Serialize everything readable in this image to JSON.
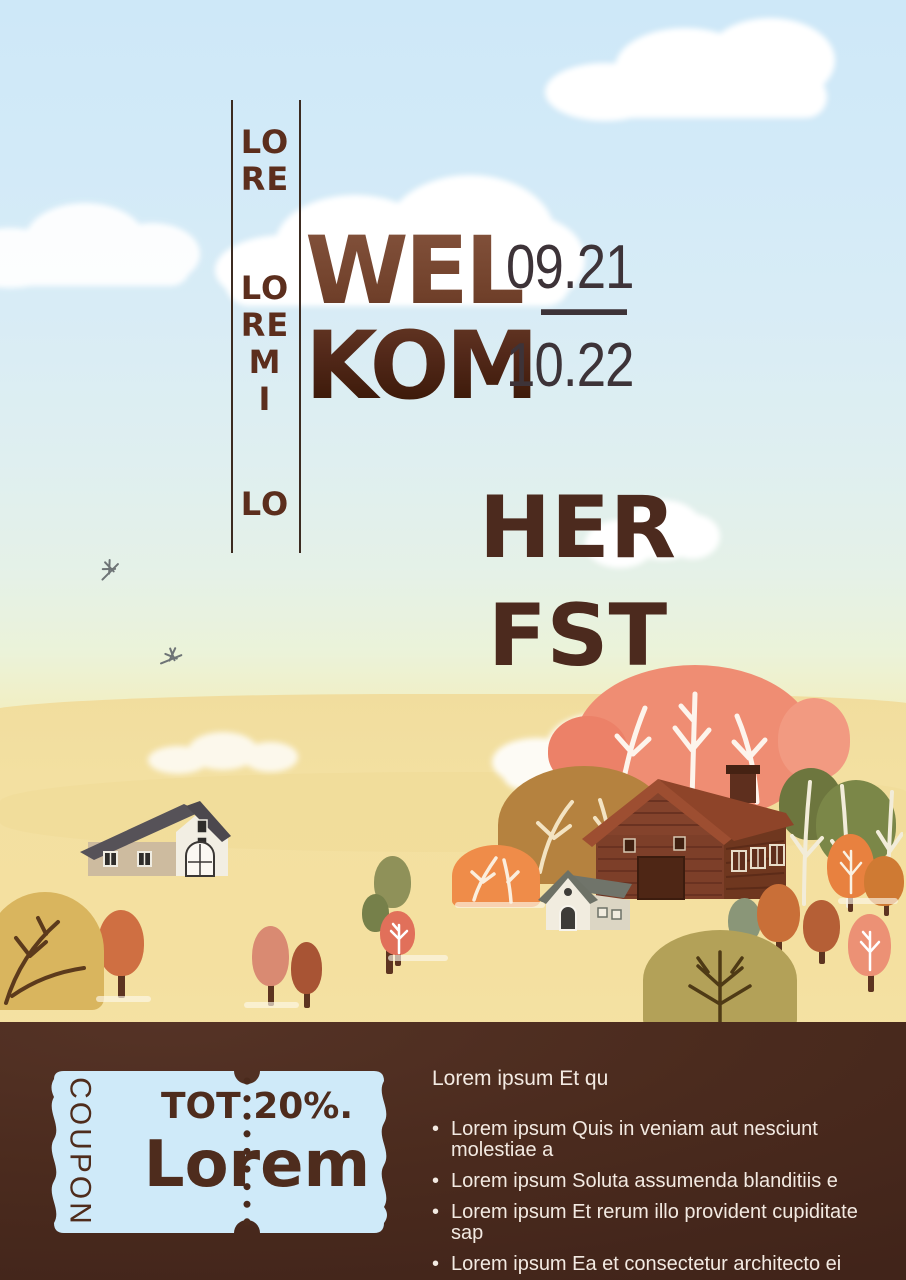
{
  "poster": {
    "vertical_banner": {
      "group1": [
        "LO",
        "RE"
      ],
      "group2": [
        "LO",
        "RE",
        "M",
        "I"
      ],
      "group3": [
        "LO"
      ]
    },
    "title": {
      "line1": "WEL",
      "line2": "KOM"
    },
    "dates": {
      "start": "09.21",
      "separator": "—",
      "end": "10.22"
    },
    "season": {
      "line1": "HER",
      "line2": "FST"
    }
  },
  "footer": {
    "coupon": {
      "stub_label": "COUPON",
      "discount": "TOT 20%.",
      "brand": "Lorem"
    },
    "info": {
      "heading": "Lorem ipsum Et qu",
      "bullets": [
        "Lorem ipsum Quis in veniam aut nesciunt molestiae a",
        "Lorem ipsum Soluta assumenda blanditiis e",
        "Lorem ipsum Et rerum illo provident cupiditate sap",
        "Lorem ipsum Ea et consectetur architecto ei"
      ]
    }
  },
  "colors": {
    "sky_top": "#cee8f8",
    "field_yellow": "#f4e1a2",
    "title_brown": "#5d2f1e",
    "season_brown": "#4c2a1e",
    "date_ink": "#3d3338",
    "footer_bg": "#4b2b1e",
    "coupon_bg": "#cfeaf9",
    "coupon_ink": "#4e2c1d",
    "footer_text": "#f3eae2"
  }
}
